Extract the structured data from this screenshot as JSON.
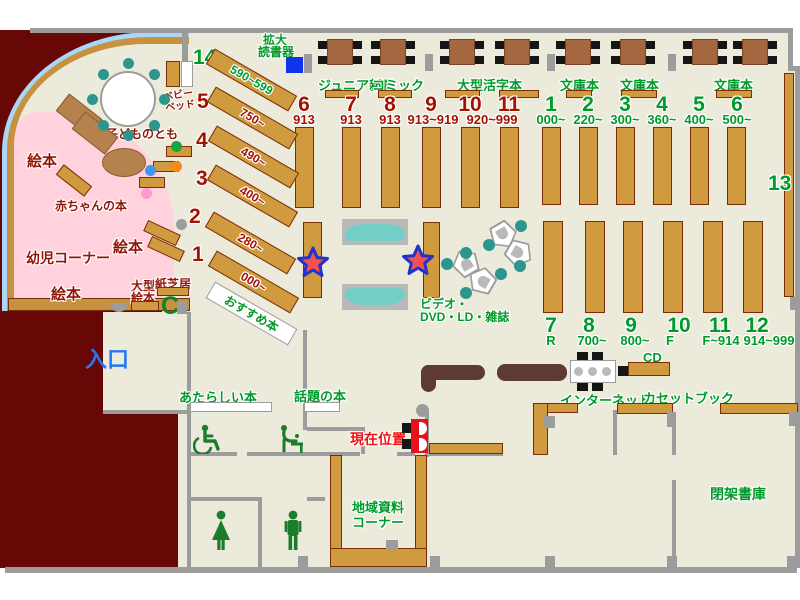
{
  "labels": {
    "entrance": "入口",
    "magnifier_l1": "拡大",
    "magnifier_l2": "読書器",
    "junior_shinsho": "ジュニア新書",
    "comic": "コミック",
    "large_print": "大型活字本",
    "bunko": "文庫本",
    "magazine": "雑誌",
    "video_l1": "ビデオ・",
    "video_l2": "DVD・LD・雑誌",
    "recommended": "おすすめ本",
    "new_books": "あたらしい本",
    "topic_books": "話題の本",
    "current_position": "現在位置",
    "internet": "インターネット",
    "cd": "CD",
    "cassette_book": "カセットブック",
    "closed_stacks": "閉架書庫",
    "local_l1": "地域資料",
    "local_l2": "コーナー",
    "infant_corner": "幼児コーナー",
    "picture_books": "絵本",
    "baby_books": "赤ちゃんの本",
    "kodomo_no_tomo": "子どものとも",
    "baby_bed_l1": "ベビー",
    "baby_bed_l2": "ベッド",
    "large_picture_l1": "大型",
    "large_picture_l2": "絵本",
    "kamishibai": "紙芝居",
    "thirteen": "13"
  },
  "shelf_groups": {
    "children_diagonal": [
      {
        "no": "14",
        "range": "590~599"
      },
      {
        "no": "5",
        "range": "750~"
      },
      {
        "no": "4",
        "range": "490~"
      },
      {
        "no": "3",
        "range": "400~"
      },
      {
        "no": "2",
        "range": "280~"
      },
      {
        "no": "1",
        "range": "000~"
      }
    ],
    "middle_top": [
      {
        "no": "6",
        "range": "913"
      },
      {
        "no": "7",
        "range": "913"
      },
      {
        "no": "8",
        "range": "913"
      },
      {
        "no": "9",
        "range": "913~919"
      },
      {
        "no": "10",
        "range": "920~999"
      },
      {
        "no": "11",
        "range": ""
      }
    ],
    "right_top": [
      {
        "no": "1",
        "range": "000~"
      },
      {
        "no": "2",
        "range": "220~"
      },
      {
        "no": "3",
        "range": "300~"
      },
      {
        "no": "4",
        "range": "360~"
      },
      {
        "no": "5",
        "range": "400~"
      },
      {
        "no": "6",
        "range": "500~"
      }
    ],
    "bottom_right": [
      {
        "no": "7",
        "range": "R"
      },
      {
        "no": "8",
        "range": "700~"
      },
      {
        "no": "9",
        "range": "800~"
      },
      {
        "no": "10",
        "range": "F"
      },
      {
        "no": "11",
        "range": "F~914"
      },
      {
        "no": "12",
        "range": "914~999"
      }
    ]
  },
  "colors": {
    "floor": "#ecebdb",
    "outside": "#680806",
    "shelf": "#cf9b3e",
    "wall": "#9c9c9c",
    "green_text": "#009a2a",
    "red_text": "#8f1505",
    "entrance_blue": "#2277f5",
    "current_red": "#f01010",
    "window_blue": "#a8d7f7",
    "pink_area": "#ffd2de",
    "teal": "#2d968c",
    "table_brown": "#a5673f",
    "desk_brown": "#5e3a34",
    "star_red": "#f45050",
    "star_border": "#2233cc",
    "device_blue": "#1133ee"
  }
}
